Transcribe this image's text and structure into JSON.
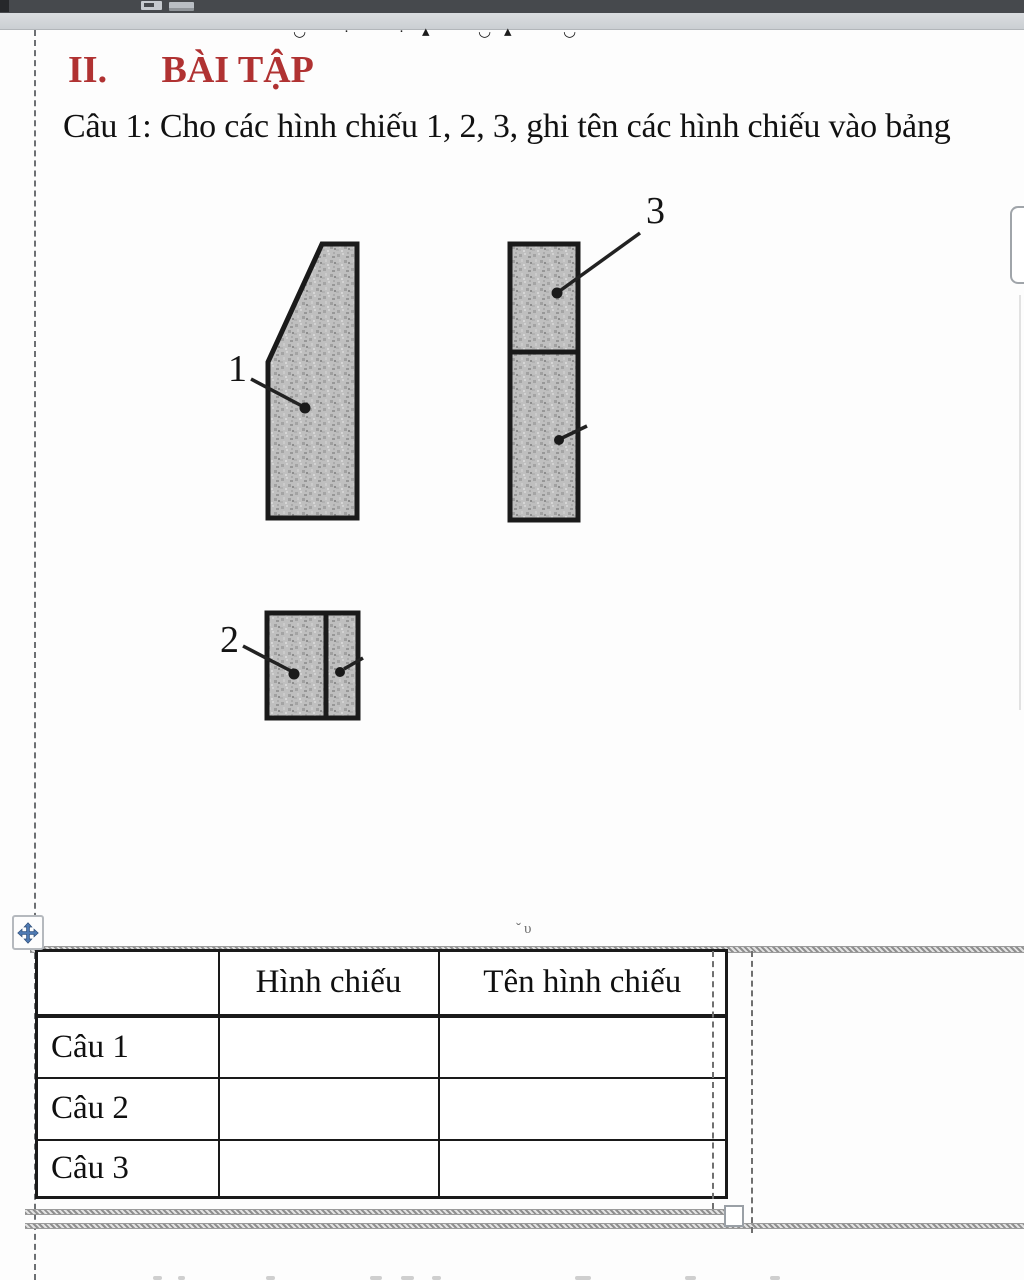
{
  "page": {
    "heading": {
      "numeral": "II.",
      "title": "BÀI TẬP"
    },
    "question": "Câu 1: Cho các hình chiếu 1, 2, 3, ghi tên các hình chiếu vào bảng"
  },
  "figures": [
    {
      "label": "1"
    },
    {
      "label": "2"
    },
    {
      "label": "3"
    }
  ],
  "table": {
    "headers": {
      "col1": "",
      "col2": "Hình chiếu",
      "col3": "Tên hình chiếu"
    },
    "rows": [
      {
        "label": "Câu 1",
        "hinh_chieu": "",
        "ten_hinh_chieu": ""
      },
      {
        "label": "Câu 2",
        "hinh_chieu": "",
        "ten_hinh_chieu": ""
      },
      {
        "label": "Câu 3",
        "hinh_chieu": "",
        "ten_hinh_chieu": ""
      }
    ]
  },
  "artifacts": {
    "top_cut_marks": [
      "◡",
      "·",
      "·",
      "▴",
      "◡",
      "▴",
      "◡"
    ],
    "table_anchor_marks": "ˇυ"
  },
  "icons": {
    "move_handle": "move-cross-icon",
    "scrollbar": "scrollbar-thumb",
    "toolbar_left": "toolbar-icon"
  },
  "colors": {
    "heading_red": "#b03232",
    "handle_blue": "#4e79b2",
    "figure_fill": "#bdbdbd",
    "toolbar_bg": "#46494d"
  }
}
